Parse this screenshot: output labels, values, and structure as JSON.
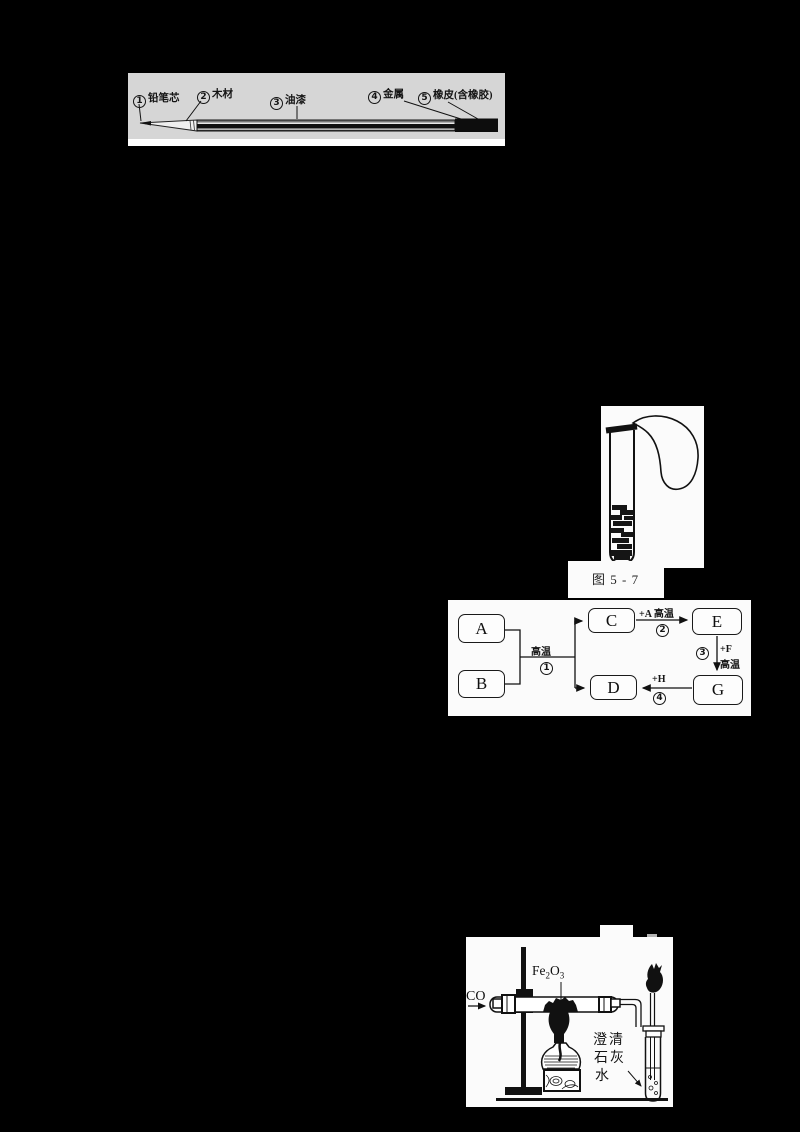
{
  "colors": {
    "page_bg": "#000000",
    "pencil_panel_bg": "#d6d6d6",
    "panel_bg": "#fbfbfb",
    "ink": "#141414",
    "scan_mark_gray": "#b3b3b3"
  },
  "pencil_figure": {
    "labels": [
      {
        "num": "1",
        "text": "铅笔芯"
      },
      {
        "num": "2",
        "text": "木材"
      },
      {
        "num": "3",
        "text": "油漆"
      },
      {
        "num": "4",
        "text": "金属"
      },
      {
        "num": "5",
        "text": "橡皮(含橡胶)"
      }
    ]
  },
  "testtube_figure": {
    "caption": "图 5 - 7"
  },
  "flowchart_figure": {
    "boxes": {
      "a": "A",
      "b": "B",
      "c": "C",
      "d": "D",
      "e": "E",
      "g": "G"
    },
    "step1_condition": "高温",
    "step1_num": "1",
    "step2_label": "+A 高温",
    "step2_num": "2",
    "step3_num": "3",
    "step3_reagent": "+F",
    "step3_condition": "高温",
    "step4_label": "+H",
    "step4_num": "4"
  },
  "apparatus_figure": {
    "gas_label": "CO",
    "solid_formula": {
      "p1": "Fe",
      "s1": "2",
      "p2": "O",
      "s2": "3"
    },
    "limewater_label": {
      "line1": "澄清",
      "line2": "石灰",
      "line3": "水"
    }
  }
}
